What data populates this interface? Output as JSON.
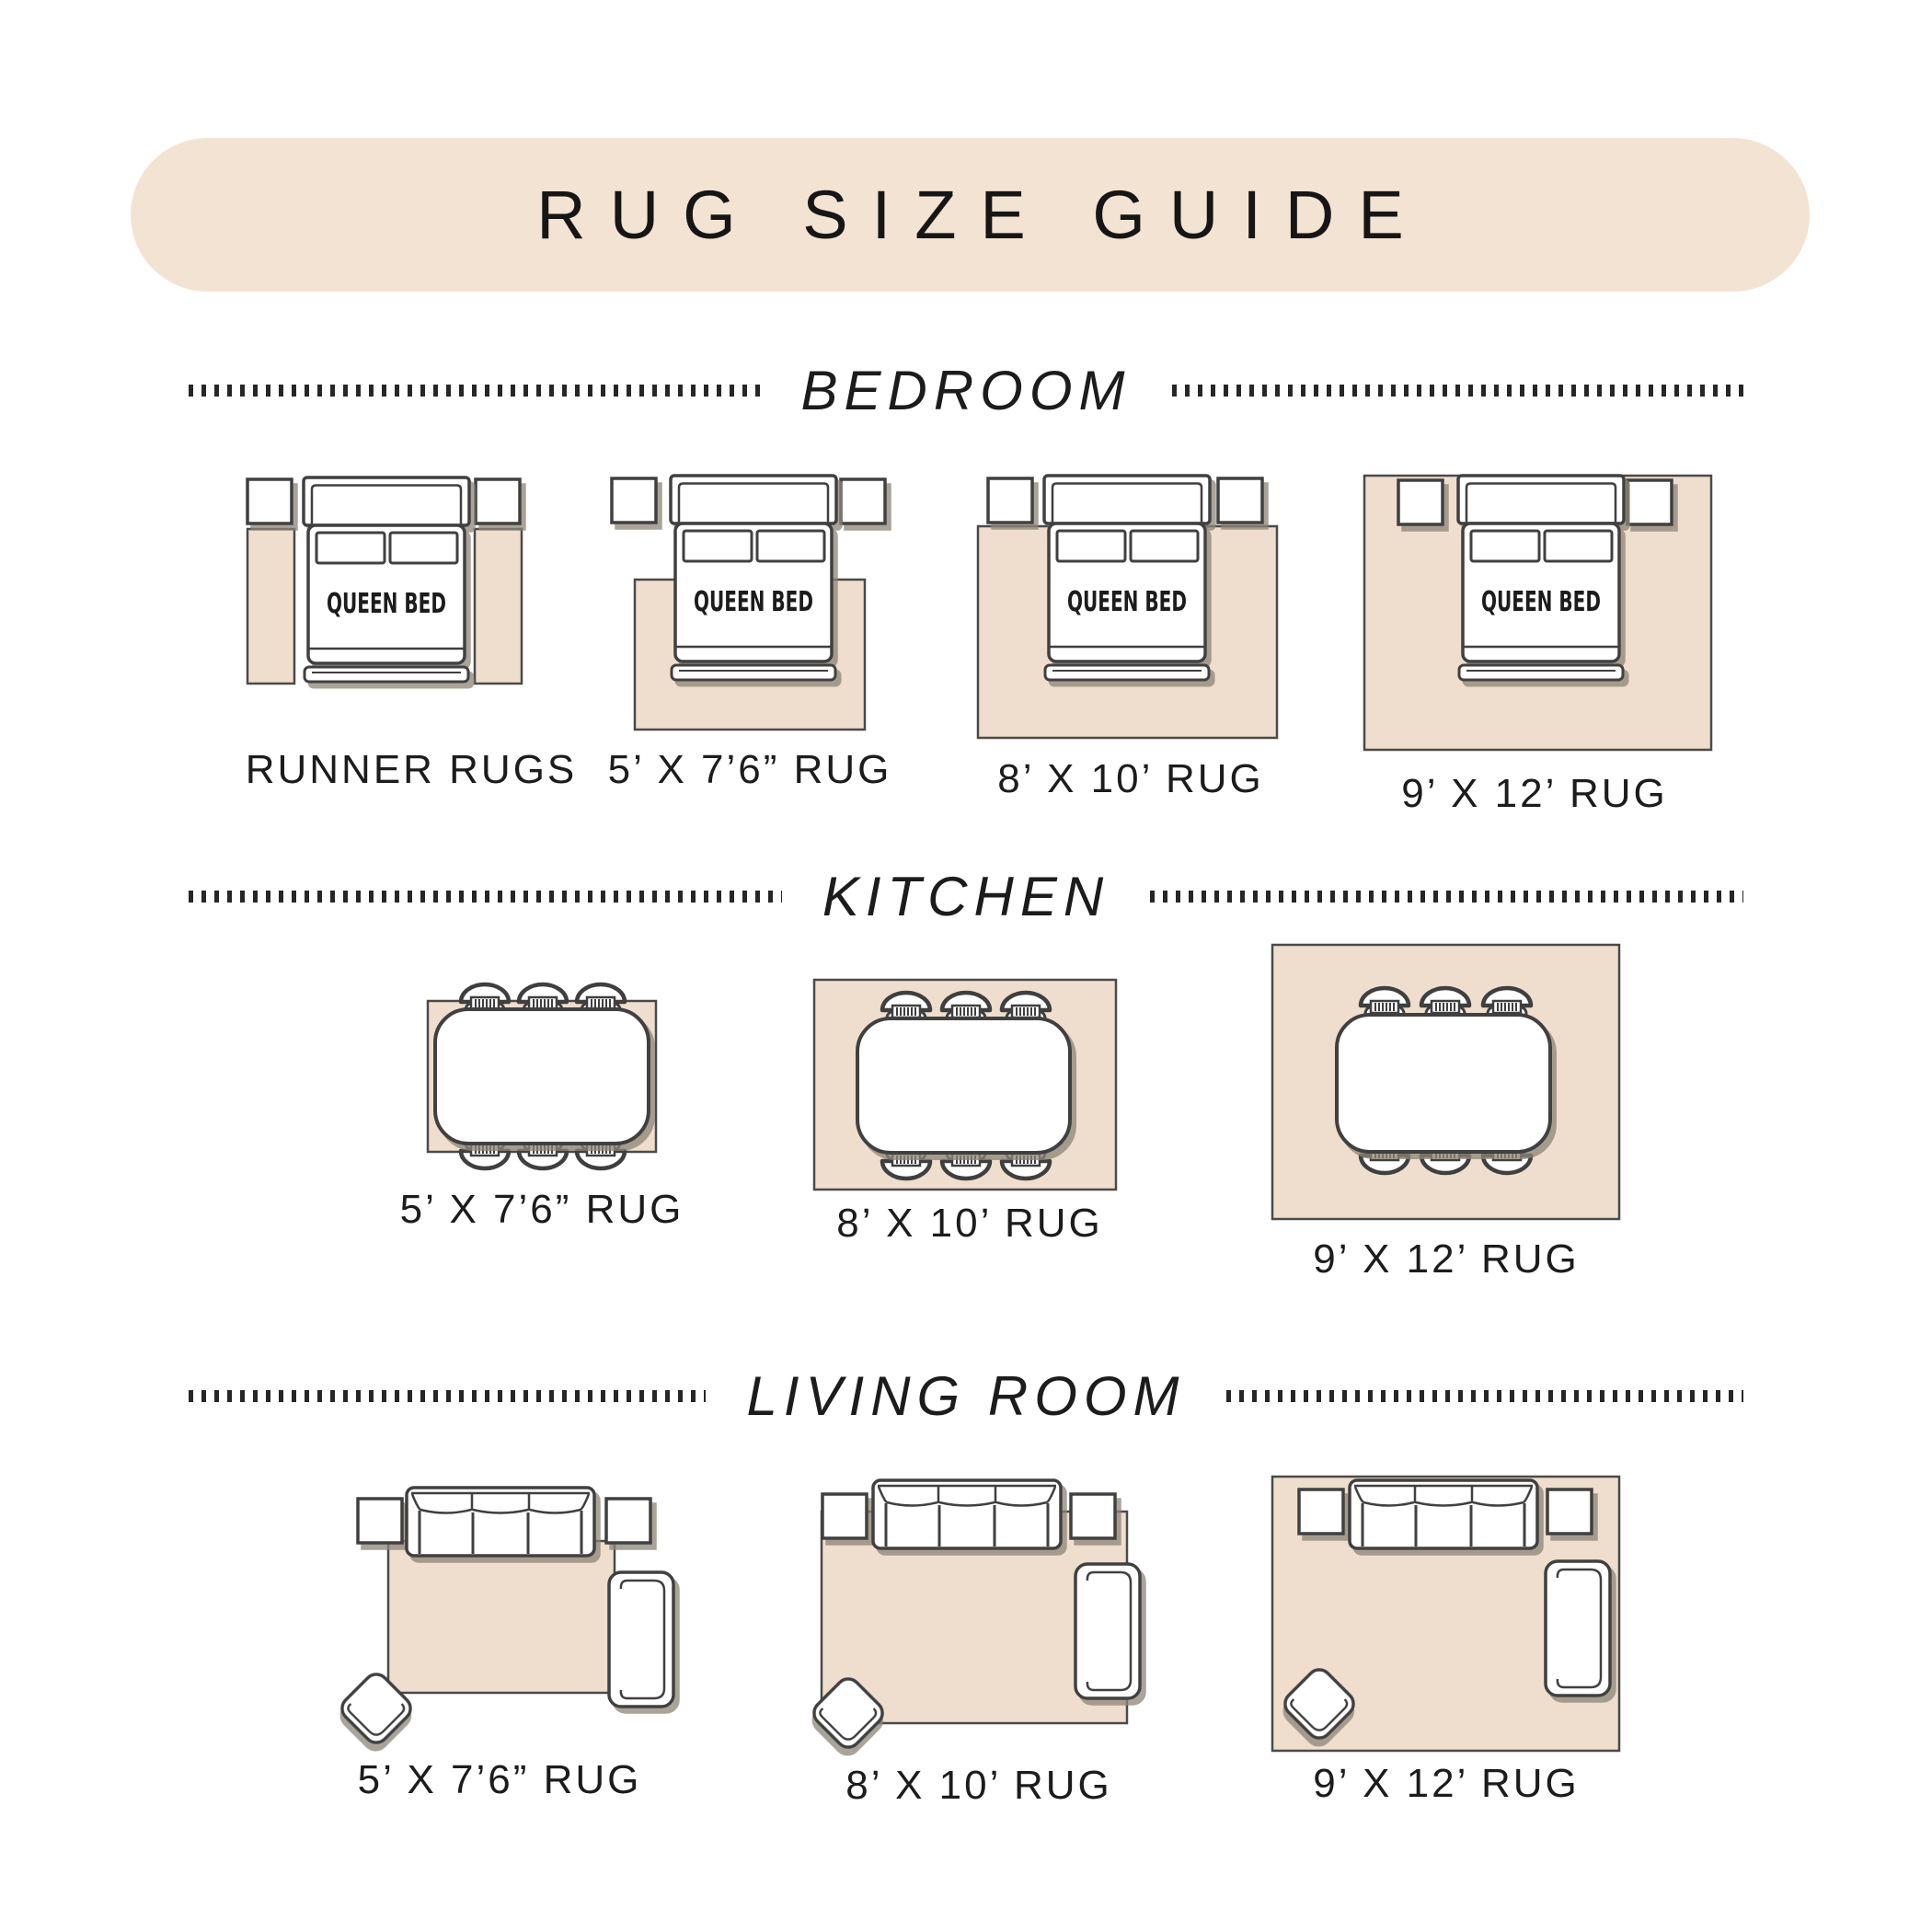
{
  "title": "RUG SIZE GUIDE",
  "bed_label": "QUEEN BED",
  "sections": {
    "bedroom": {
      "name": "BEDROOM",
      "labels": [
        "RUNNER RUGS",
        "5’ X 7’6” RUG",
        "8’ X 10’ RUG",
        "9’ X 12’ RUG"
      ]
    },
    "kitchen": {
      "name": "KITCHEN",
      "labels": [
        "5’ X 7’6” RUG",
        "8’ X 10’ RUG",
        "9’ X 12’ RUG"
      ]
    },
    "living_room": {
      "name": "LIVING ROOM",
      "labels": [
        "5’ X 7’6” RUG",
        "8’ X 10’ RUG",
        "9’ X 12’ RUG"
      ]
    }
  },
  "colors": {
    "banner": "#f3e3d2",
    "rug": "#efdecd",
    "rugline": "#4a4a4a",
    "outline": "#3f3f3f",
    "text": "#1c1c1c",
    "shadow": "#8c8478"
  }
}
